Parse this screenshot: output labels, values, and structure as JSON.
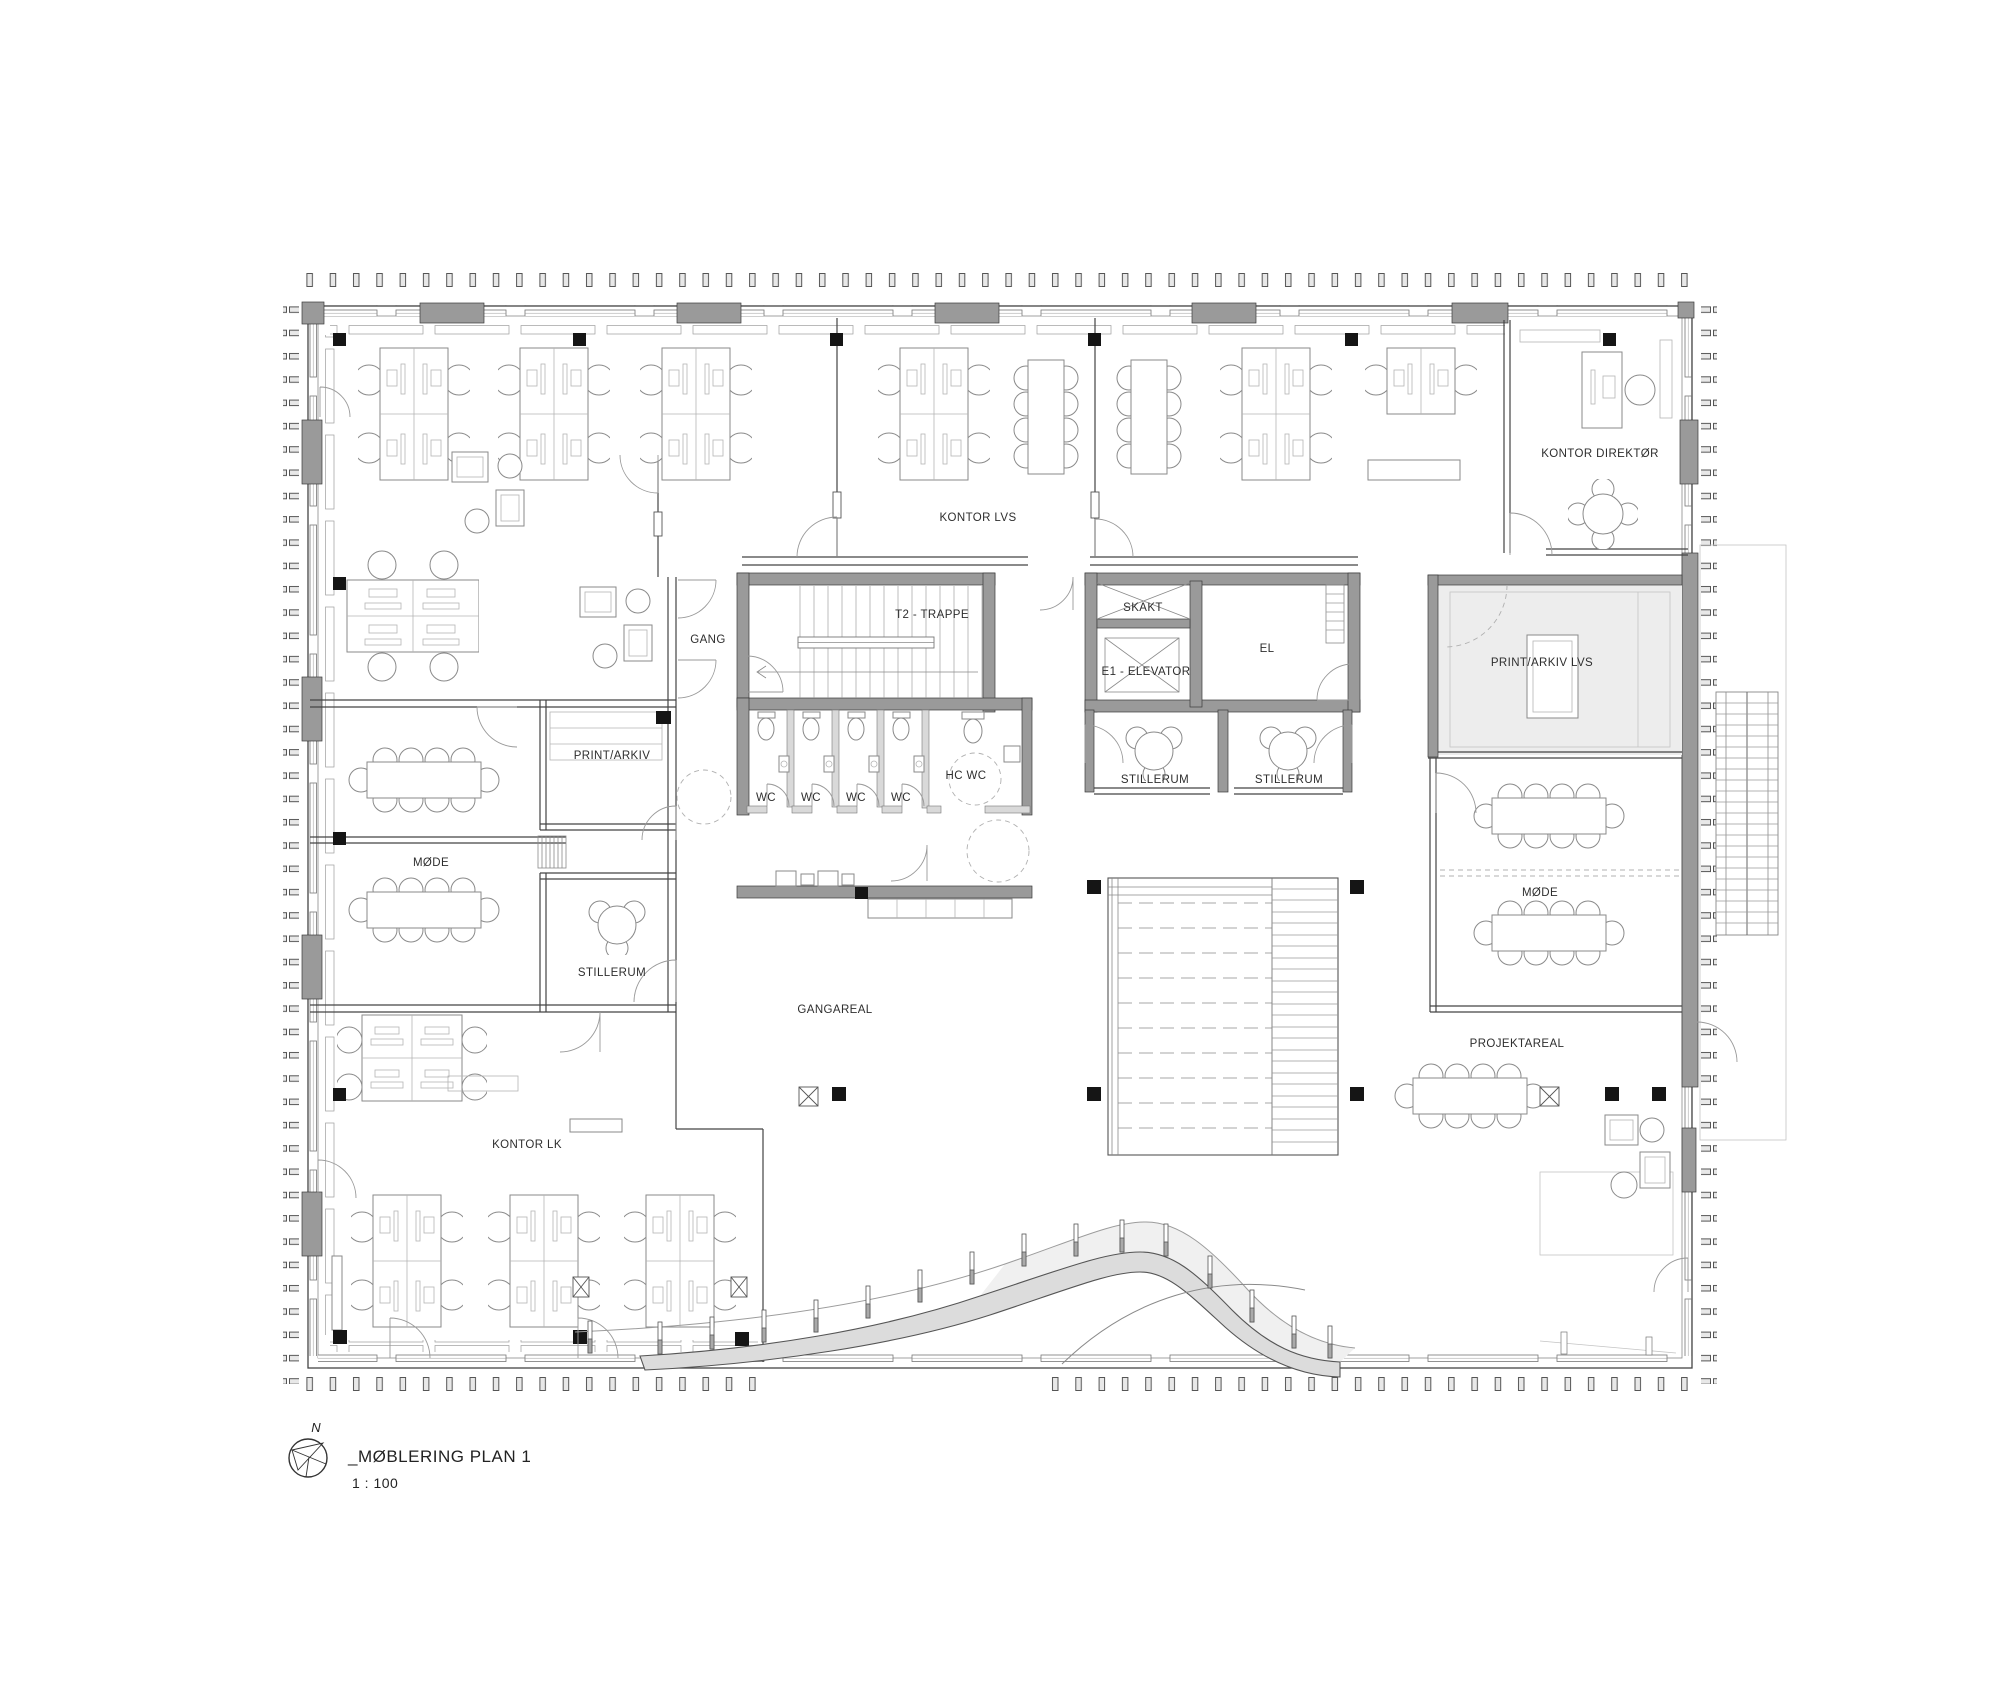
{
  "sheet": {
    "title": "_MØBLERING PLAN 1",
    "scale": "1 : 100",
    "north_label": "N"
  },
  "rooms": {
    "kontor_lvs": "KONTOR LVS",
    "kontor_direktor": "KONTOR DIREKTØR",
    "kontor_lk": "KONTOR LK",
    "gang": "GANG",
    "trappe": "T2 - TRAPPE",
    "skakt": "SKAKT",
    "elevator": "E1 - ELEVATOR",
    "el": "EL",
    "stillerum_core_left": "STILLERUM",
    "stillerum_core_right": "STILLERUM",
    "print_arkiv_lvs": "PRINT/ARKIV LVS",
    "print_arkiv": "PRINT/ARKIV",
    "hc_wc": "HC WC",
    "wc_1": "WC",
    "wc_2": "WC",
    "wc_3": "WC",
    "wc_4": "WC",
    "mode_left": "MØDE",
    "stillerum_left": "STILLERUM",
    "mode_right": "MØDE",
    "gangareal": "GANGAREAL",
    "projektareal": "PROJEKTAREAL"
  },
  "colors": {
    "wall_gray": "#9a9a9a",
    "light_fill": "#ededed",
    "ramp_fill": "#dcdcdc",
    "line": "#444444",
    "black": "#151515"
  }
}
